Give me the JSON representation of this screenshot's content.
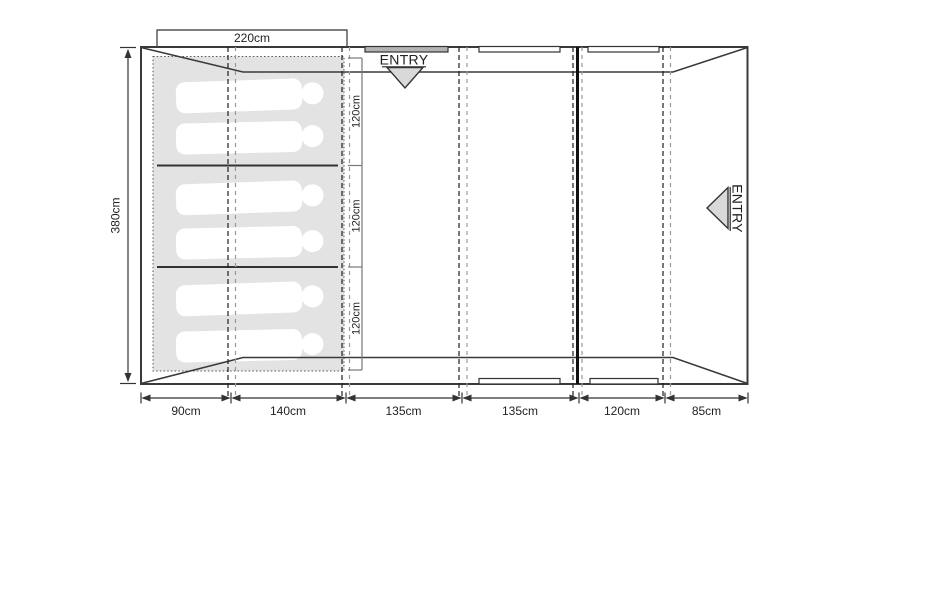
{
  "entries": {
    "top": "ENTRY",
    "right": "ENTRY"
  },
  "dimensions": {
    "inner_width": "220cm",
    "inner_height": "380cm",
    "bedroom_sections": [
      "120cm",
      "120cm",
      "120cm"
    ],
    "bottom_segments": [
      "90cm",
      "140cm",
      "135cm",
      "135cm",
      "120cm",
      "85cm"
    ]
  },
  "sleeping_area": {
    "figure_count": 6
  },
  "colors": {
    "outline": "#3a3a3a",
    "sleeping_area_fill": "#e3e3e3",
    "entry_marker_fill": "#d9d9d9",
    "door_bar_fill": "#b3b3b3",
    "seam_dash_dark": "#1f1f1f",
    "seam_dash_light": "#999999"
  }
}
